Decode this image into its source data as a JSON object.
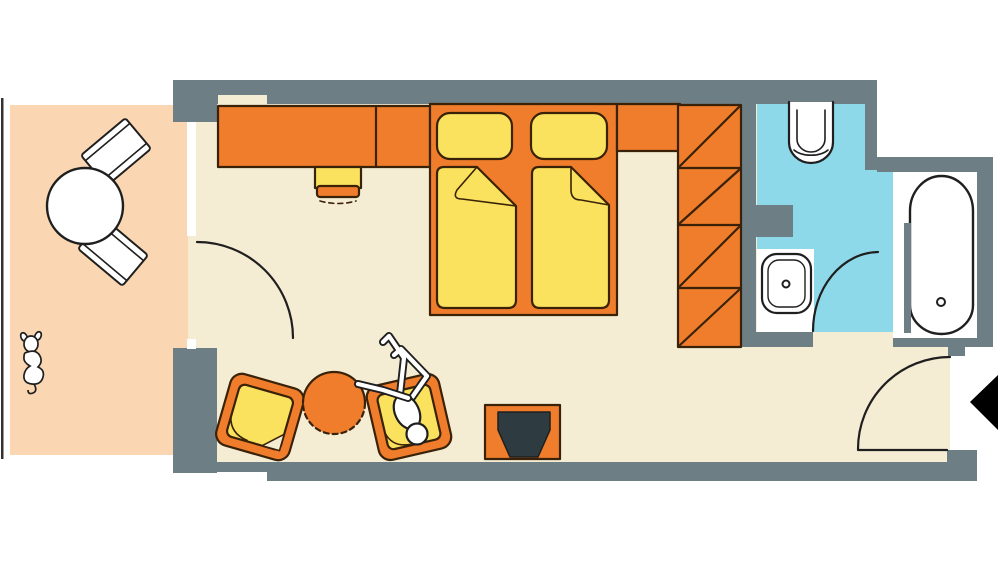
{
  "page": {
    "title": "Hotel guest room floor plan with balcony and bathroom"
  },
  "colors": {
    "background": "#ffffff",
    "wall": "#6d7e84",
    "floor_room": "#f5ecd4",
    "floor_balcony": "#fad7b2",
    "floor_bathroom": "#8ed9e9",
    "furniture_orange": "#ef7d2c",
    "furniture_yellow": "#fae25e",
    "fixture_white": "#ffffff",
    "tv_screen": "#2e3c42",
    "outline_dark": "#3a2208",
    "line_black": "#1f1f1f",
    "railing": "#333333",
    "entrance_arrow": "#000000"
  },
  "objects": {
    "balcony": [
      "balcony-railing",
      "round-table",
      "folding-chair-upper",
      "folding-chair-lower",
      "dog"
    ],
    "bedroom": [
      "desk",
      "desk-stool",
      "bed-platform",
      "pillow-left",
      "pillow-right",
      "mattress-left",
      "mattress-right",
      "headboard-shelf",
      "wardrobe",
      "armchair",
      "round-side-table",
      "lounge-chair",
      "person",
      "tv-stand",
      "tv"
    ],
    "bathroom": [
      "toilet",
      "washbasin",
      "bathtub",
      "bathtub-drain"
    ],
    "doors": [
      "balcony-door-swing",
      "bathroom-door-swing",
      "entrance-door-swing",
      "entrance-arrow"
    ]
  }
}
